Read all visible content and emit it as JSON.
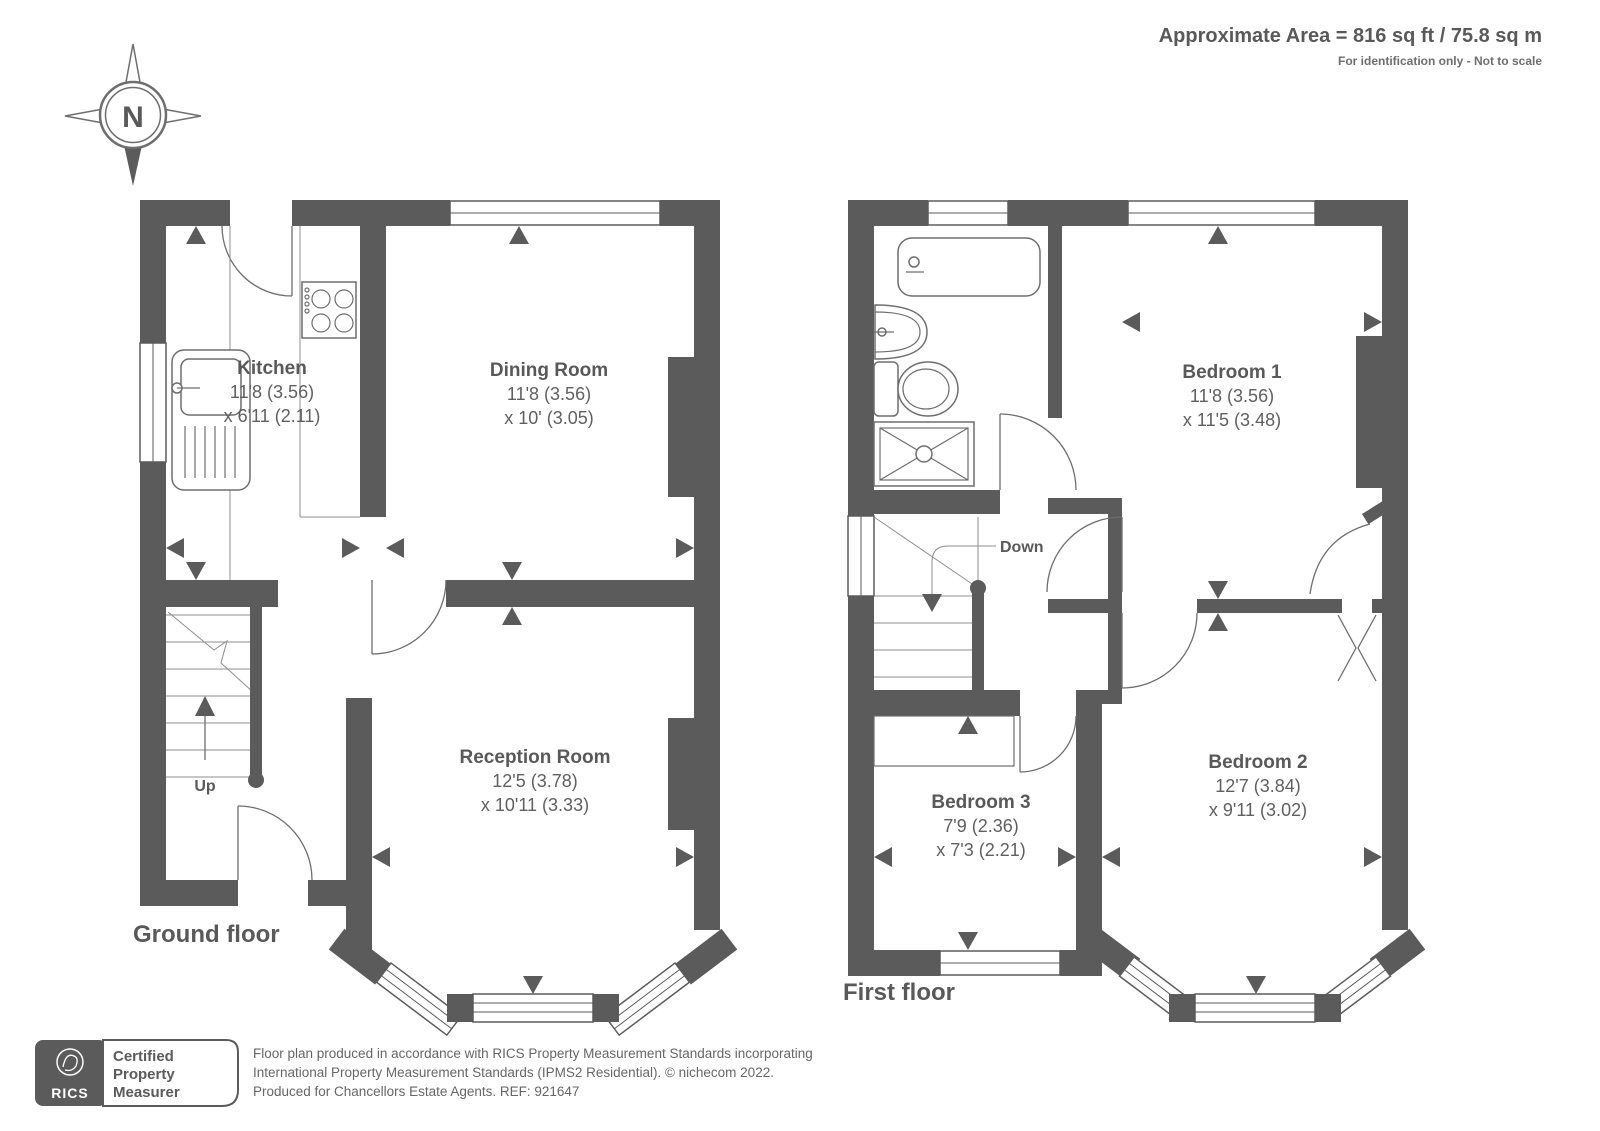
{
  "header": {
    "area_text": "Approximate Area = 816 sq ft / 75.8 sq m",
    "note": "For identification only - Not to scale"
  },
  "compass": {
    "label": "N"
  },
  "ground_floor": {
    "label": "Ground floor",
    "stairs_label": "Up",
    "kitchen": {
      "name": "Kitchen",
      "dim1": "11'8 (3.56)",
      "dim2": "x 6'11 (2.11)"
    },
    "dining": {
      "name": "Dining Room",
      "dim1": "11'8 (3.56)",
      "dim2": "x 10' (3.05)"
    },
    "reception": {
      "name": "Reception Room",
      "dim1": "12'5 (3.78)",
      "dim2": "x 10'11 (3.33)"
    }
  },
  "first_floor": {
    "label": "First floor",
    "stairs_label": "Down",
    "bedroom1": {
      "name": "Bedroom 1",
      "dim1": "11'8 (3.56)",
      "dim2": "x 11'5 (3.48)"
    },
    "bedroom2": {
      "name": "Bedroom 2",
      "dim1": "12'7 (3.84)",
      "dim2": "x 9'11 (3.02)"
    },
    "bedroom3": {
      "name": "Bedroom 3",
      "dim1": "7'9 (2.36)",
      "dim2": "x 7'3 (2.21)"
    }
  },
  "footer": {
    "badge": {
      "org": "RICS",
      "line1": "Certified",
      "line2": "Property",
      "line3": "Measurer"
    },
    "line1": "Floor plan produced in accordance with RICS Property Measurement Standards incorporating",
    "line2": "International Property Measurement Standards (IPMS2 Residential).  © nichecom 2022.",
    "line3": "Produced for Chancellors Estate Agents.   REF: 921647"
  },
  "colors": {
    "wall": "#5b5b5b",
    "text": "#595959",
    "line": "#6e6e6e"
  }
}
